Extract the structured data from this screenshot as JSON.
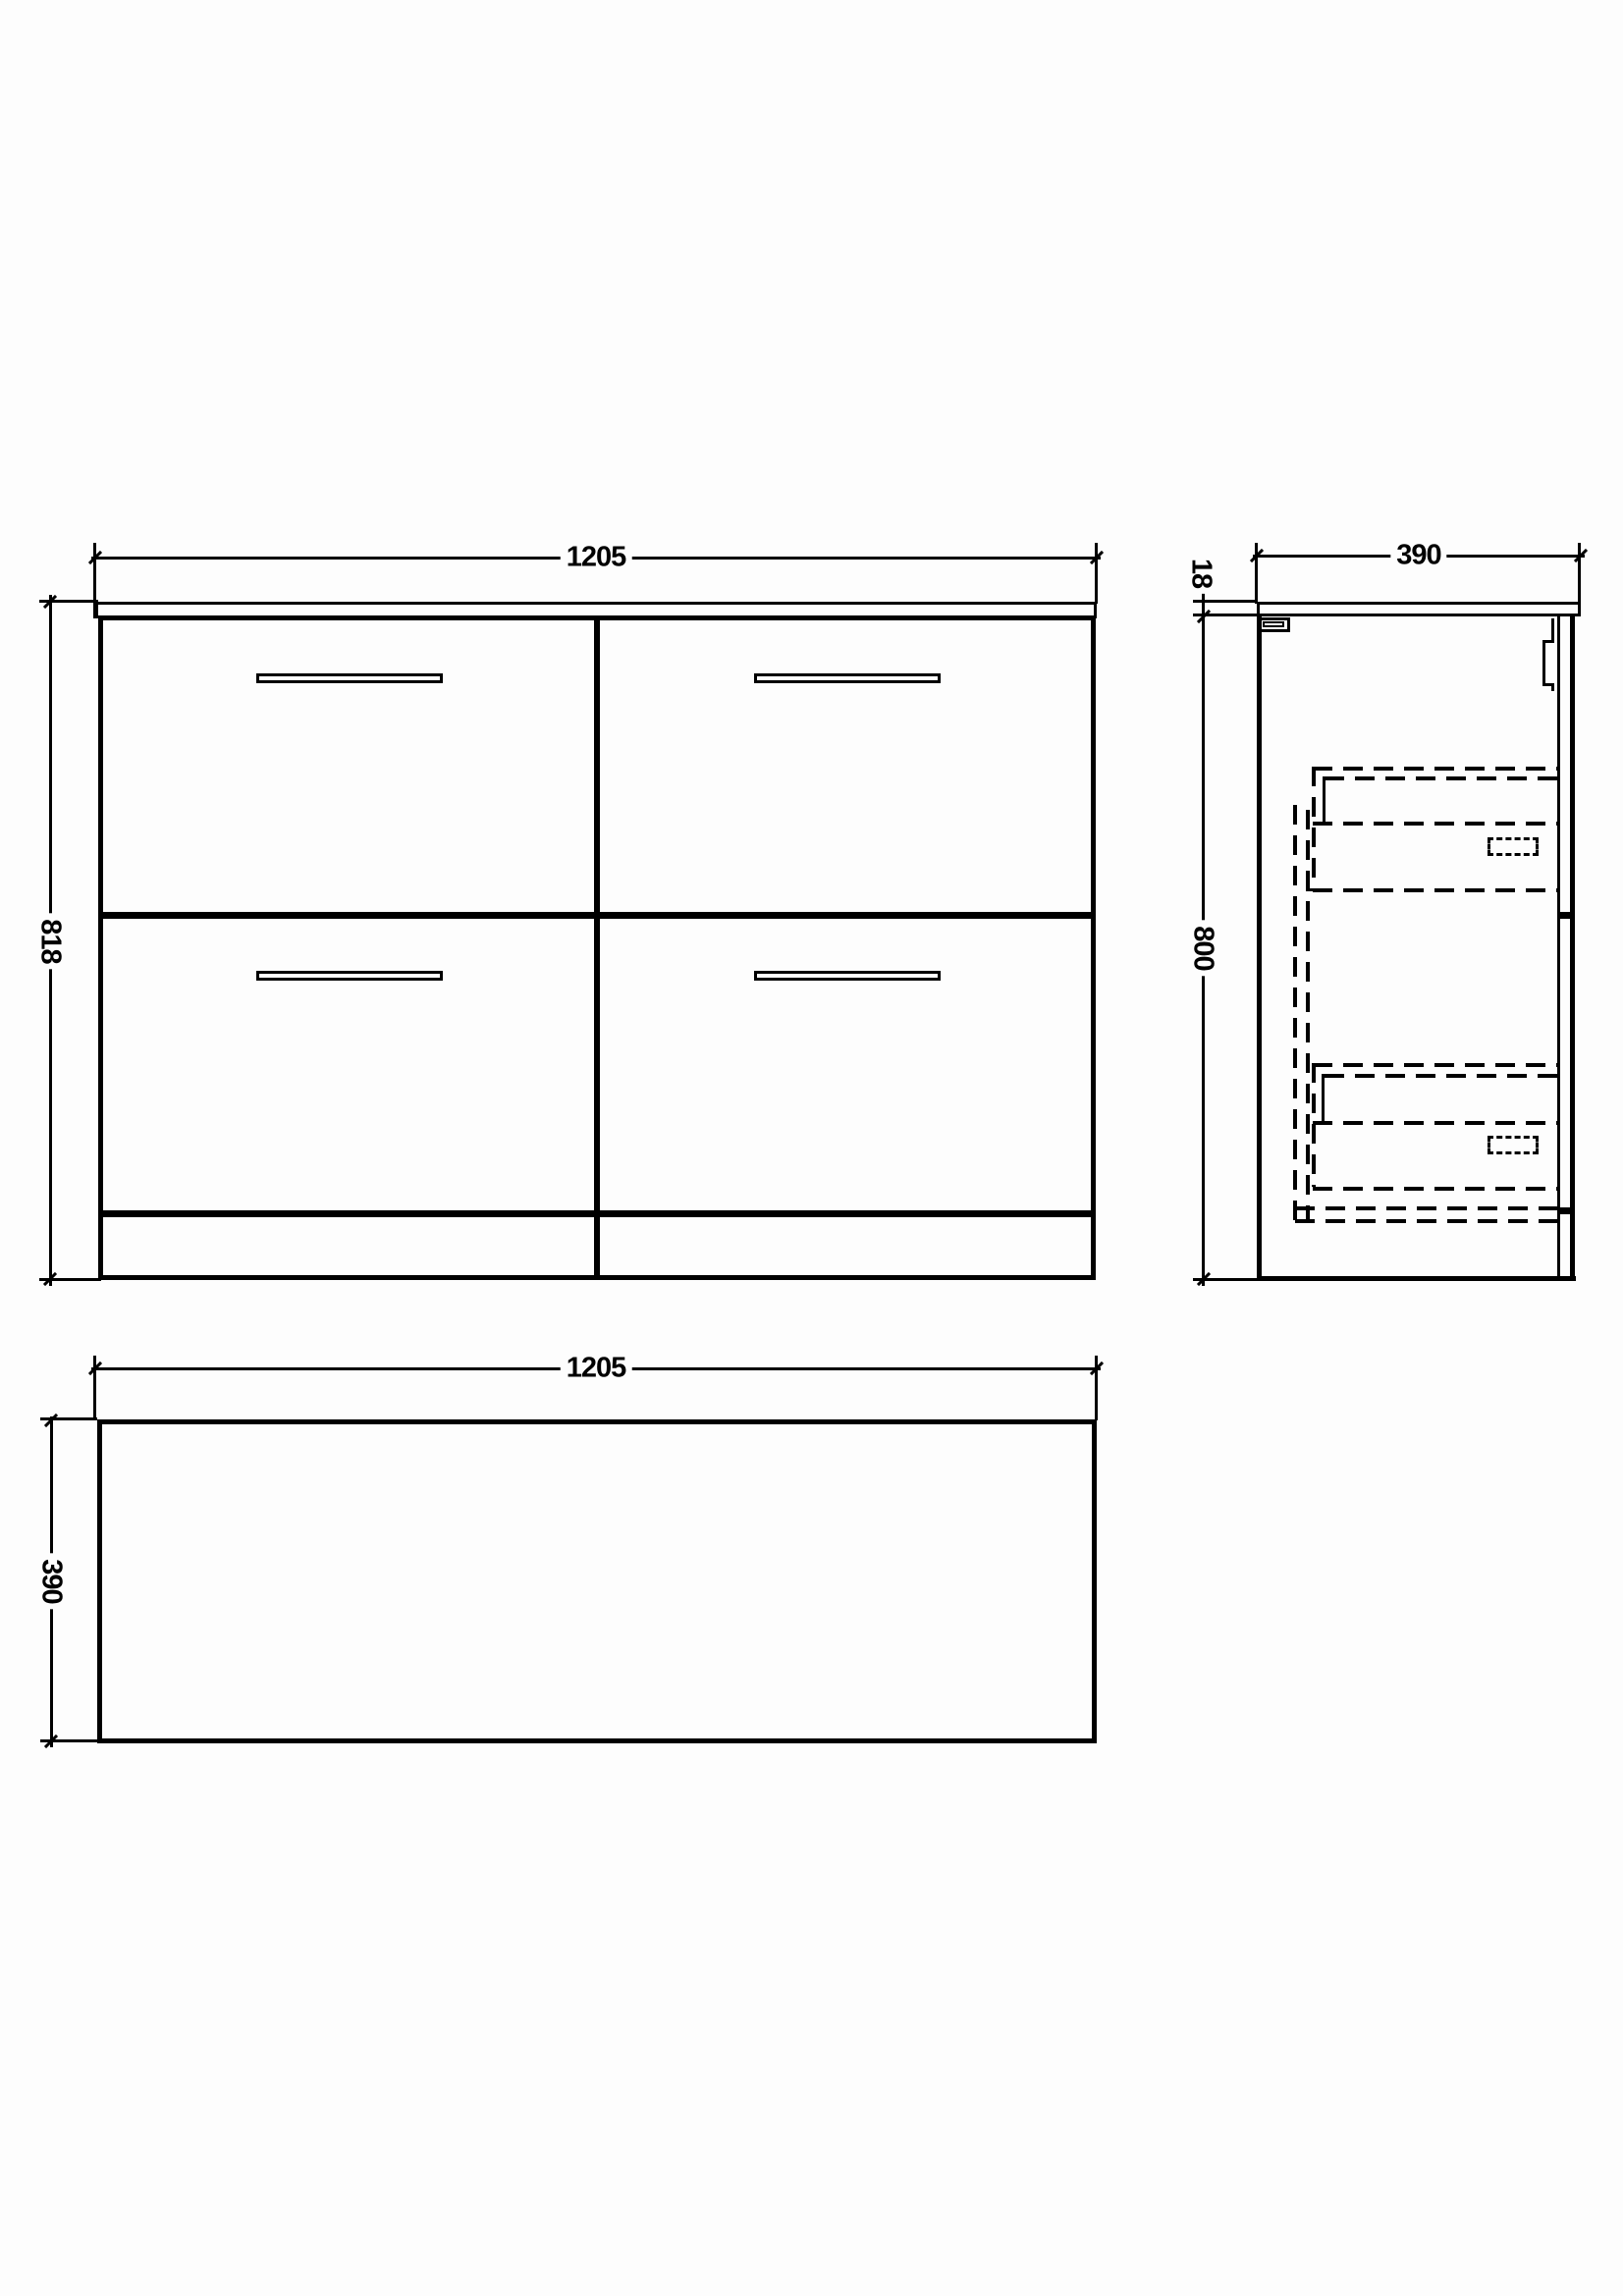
{
  "views": {
    "front": {
      "width": "1205",
      "height": "818"
    },
    "side": {
      "depth": "390",
      "worktop": "18",
      "height": "800"
    },
    "plan": {
      "width": "1205",
      "depth": "390"
    }
  },
  "colors": {
    "line": "#000000",
    "background": "#fdfdfd"
  }
}
